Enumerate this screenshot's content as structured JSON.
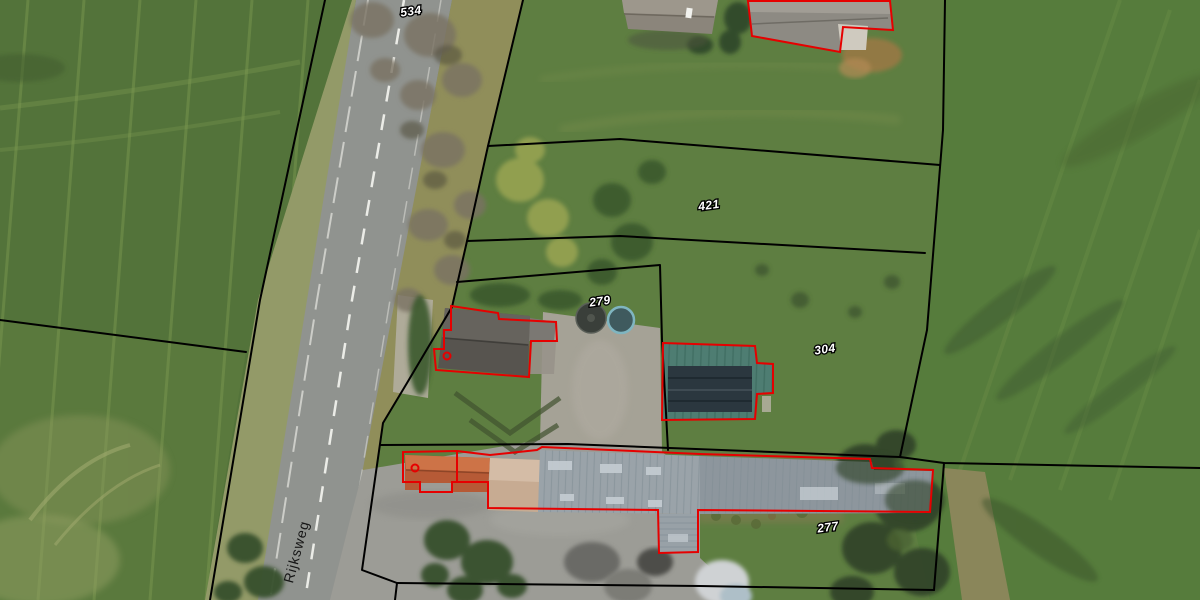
{
  "map": {
    "description": "Aerial cadastral map with parcel boundaries and highlighted building outlines",
    "street": {
      "name": "Rijksweg"
    },
    "parcels": [
      {
        "number": "534"
      },
      {
        "number": "421"
      },
      {
        "number": "279"
      },
      {
        "number": "304"
      },
      {
        "number": "277"
      }
    ],
    "colors": {
      "parcel_boundary": "#000000",
      "building_outline": "#e60000",
      "parcel_label_fill": "#ffffff",
      "parcel_label_outline": "#000000",
      "street_label": "#161616",
      "road_asphalt": "#90938f",
      "field_green": "#54743a",
      "lawn_green": "#5e7e41",
      "warehouse_roof": "#99a2a8",
      "blue_building_roof": "#4e7d72",
      "orange_roof": "#b65a36"
    }
  }
}
